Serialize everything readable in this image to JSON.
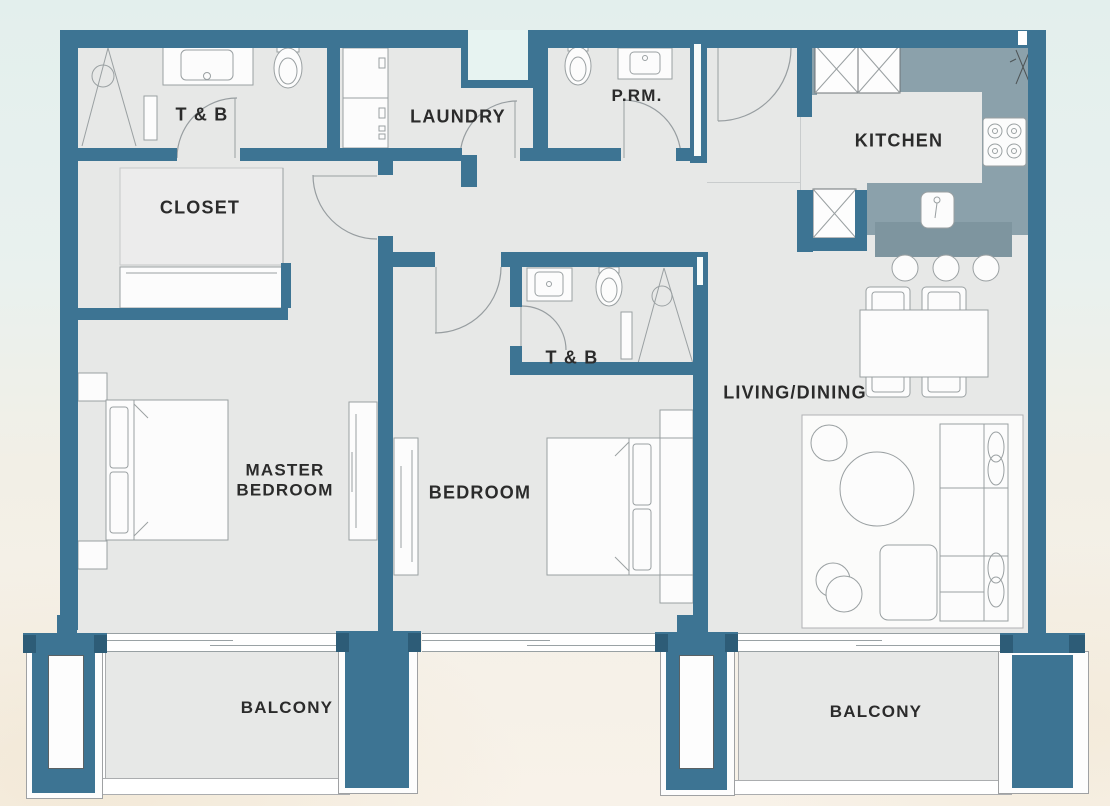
{
  "plan_title": "2-bedroom apartment floor plan",
  "rooms": {
    "tb_master": {
      "label": "T & B"
    },
    "laundry": {
      "label": "LAUNDRY"
    },
    "powder_room": {
      "label": "P.RM."
    },
    "kitchen": {
      "label": "KITCHEN"
    },
    "closet": {
      "label": "CLOSET"
    },
    "tb_bedroom": {
      "label": "T & B"
    },
    "living_dining": {
      "label": "LIVING/DINING"
    },
    "master_bedroom": {
      "label": "MASTER BEDROOM"
    },
    "bedroom": {
      "label": "BEDROOM"
    },
    "balcony_left": {
      "label": "BALCONY"
    },
    "balcony_right": {
      "label": "BALCONY"
    }
  },
  "colors": {
    "wall": "#3d7493",
    "wall_dark": "#2d5c77",
    "floor": "#e7e8e7",
    "kitchen_floor": "#8ba1ab",
    "bar": "#7e959f",
    "background_top": "#e3efed",
    "background_bottom": "#f8f2e9",
    "furniture_fill": "#fcfcfc",
    "line": "#9aa0a2",
    "label": "#2b2b2b"
  }
}
